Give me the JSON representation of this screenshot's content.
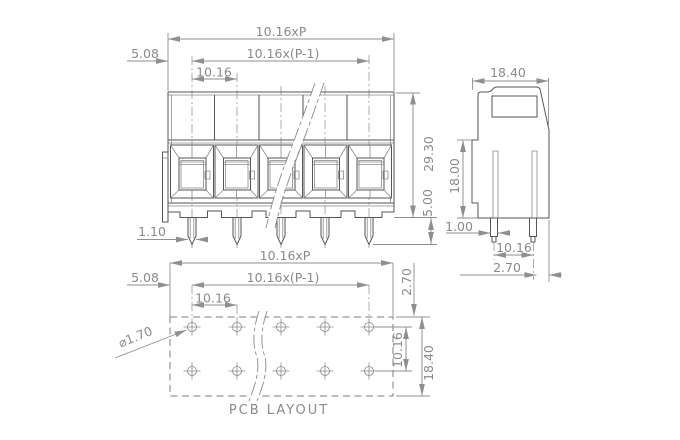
{
  "drawing": {
    "poles_shown": 5,
    "colors": {
      "background": "#ffffff",
      "geometry_line": "#565656",
      "dimension_line": "#8f8f8f",
      "text": "#8a8a8a"
    },
    "front_view": {
      "dim_total_width": "10.16xP",
      "dim_pole_span": "10.16x(P-1)",
      "dim_pitch": "10.16",
      "dim_end_margin": "5.08",
      "dim_body_height": "29.30",
      "dim_pin_length": "5.00",
      "dim_pin_width": "1.10"
    },
    "side_view": {
      "dim_depth": "18.40",
      "dim_base_height": "18.00",
      "dim_pin_width": "1.00",
      "dim_pin_pitch": "10.16",
      "dim_pin_to_edge": "2.70"
    },
    "pcb_layout": {
      "title": "PCB LAYOUT",
      "dim_total_width": "10.16xP",
      "dim_pole_span": "10.16x(P-1)",
      "dim_pitch": "10.16",
      "dim_end_margin": "5.08",
      "dim_hole_diameter": "⌀1.70",
      "dim_edge_to_row": "2.70",
      "dim_row_spacing": "10.16",
      "dim_outline_height": "18.40"
    }
  }
}
